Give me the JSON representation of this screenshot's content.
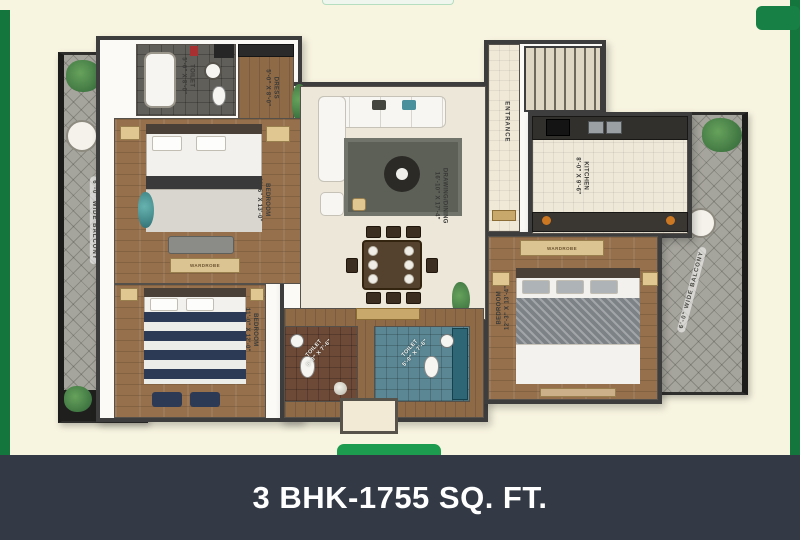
{
  "frame": {
    "background": "#f7f4e0",
    "side_strip_color": "#15763d",
    "notch_color": "#1d9b4f",
    "corner_box_color": "#178044"
  },
  "footer": {
    "title": "3 BHK-1755 SQ. FT.",
    "background": "#333a46"
  },
  "plan": {
    "balcony_left_label": "6'-0\" WIDE BALCONY",
    "balcony_right_label": "6'-0\" WIDE BALCONY",
    "wardrobe_label": "WARDROBE",
    "rooms": {
      "toilet_top": {
        "name": "TOILET",
        "dims": "5'-0\" X 8'-0\""
      },
      "dress": {
        "name": "DRESS",
        "dims": "5'-0\" X 8'-0\""
      },
      "bedroom_left": {
        "name": "BEDROOM",
        "dims": "11'-6\" X 13'-0\""
      },
      "drawing_dining": {
        "name": "DRAWING/DINING",
        "dims": "16'-10\" X 17'-4\""
      },
      "entrance": {
        "name": "ENTRANCE"
      },
      "kitchen": {
        "name": "KITCHEN",
        "dims": "8'-0\" X 9'-6\""
      },
      "bedroom_right": {
        "name": "BEDROOM",
        "dims": "12'-3\" X 13'-4\""
      },
      "bedroom_bottom": {
        "name": "BEDROOM",
        "dims": "11'-0\" X 12'-0\""
      },
      "toilet_bottom_left": {
        "name": "TOILET",
        "dims": "5'-0\" X 7'-6\""
      },
      "toilet_bottom_right": {
        "name": "TOILET",
        "dims": "5'-0\" X 7'-6\""
      }
    }
  }
}
